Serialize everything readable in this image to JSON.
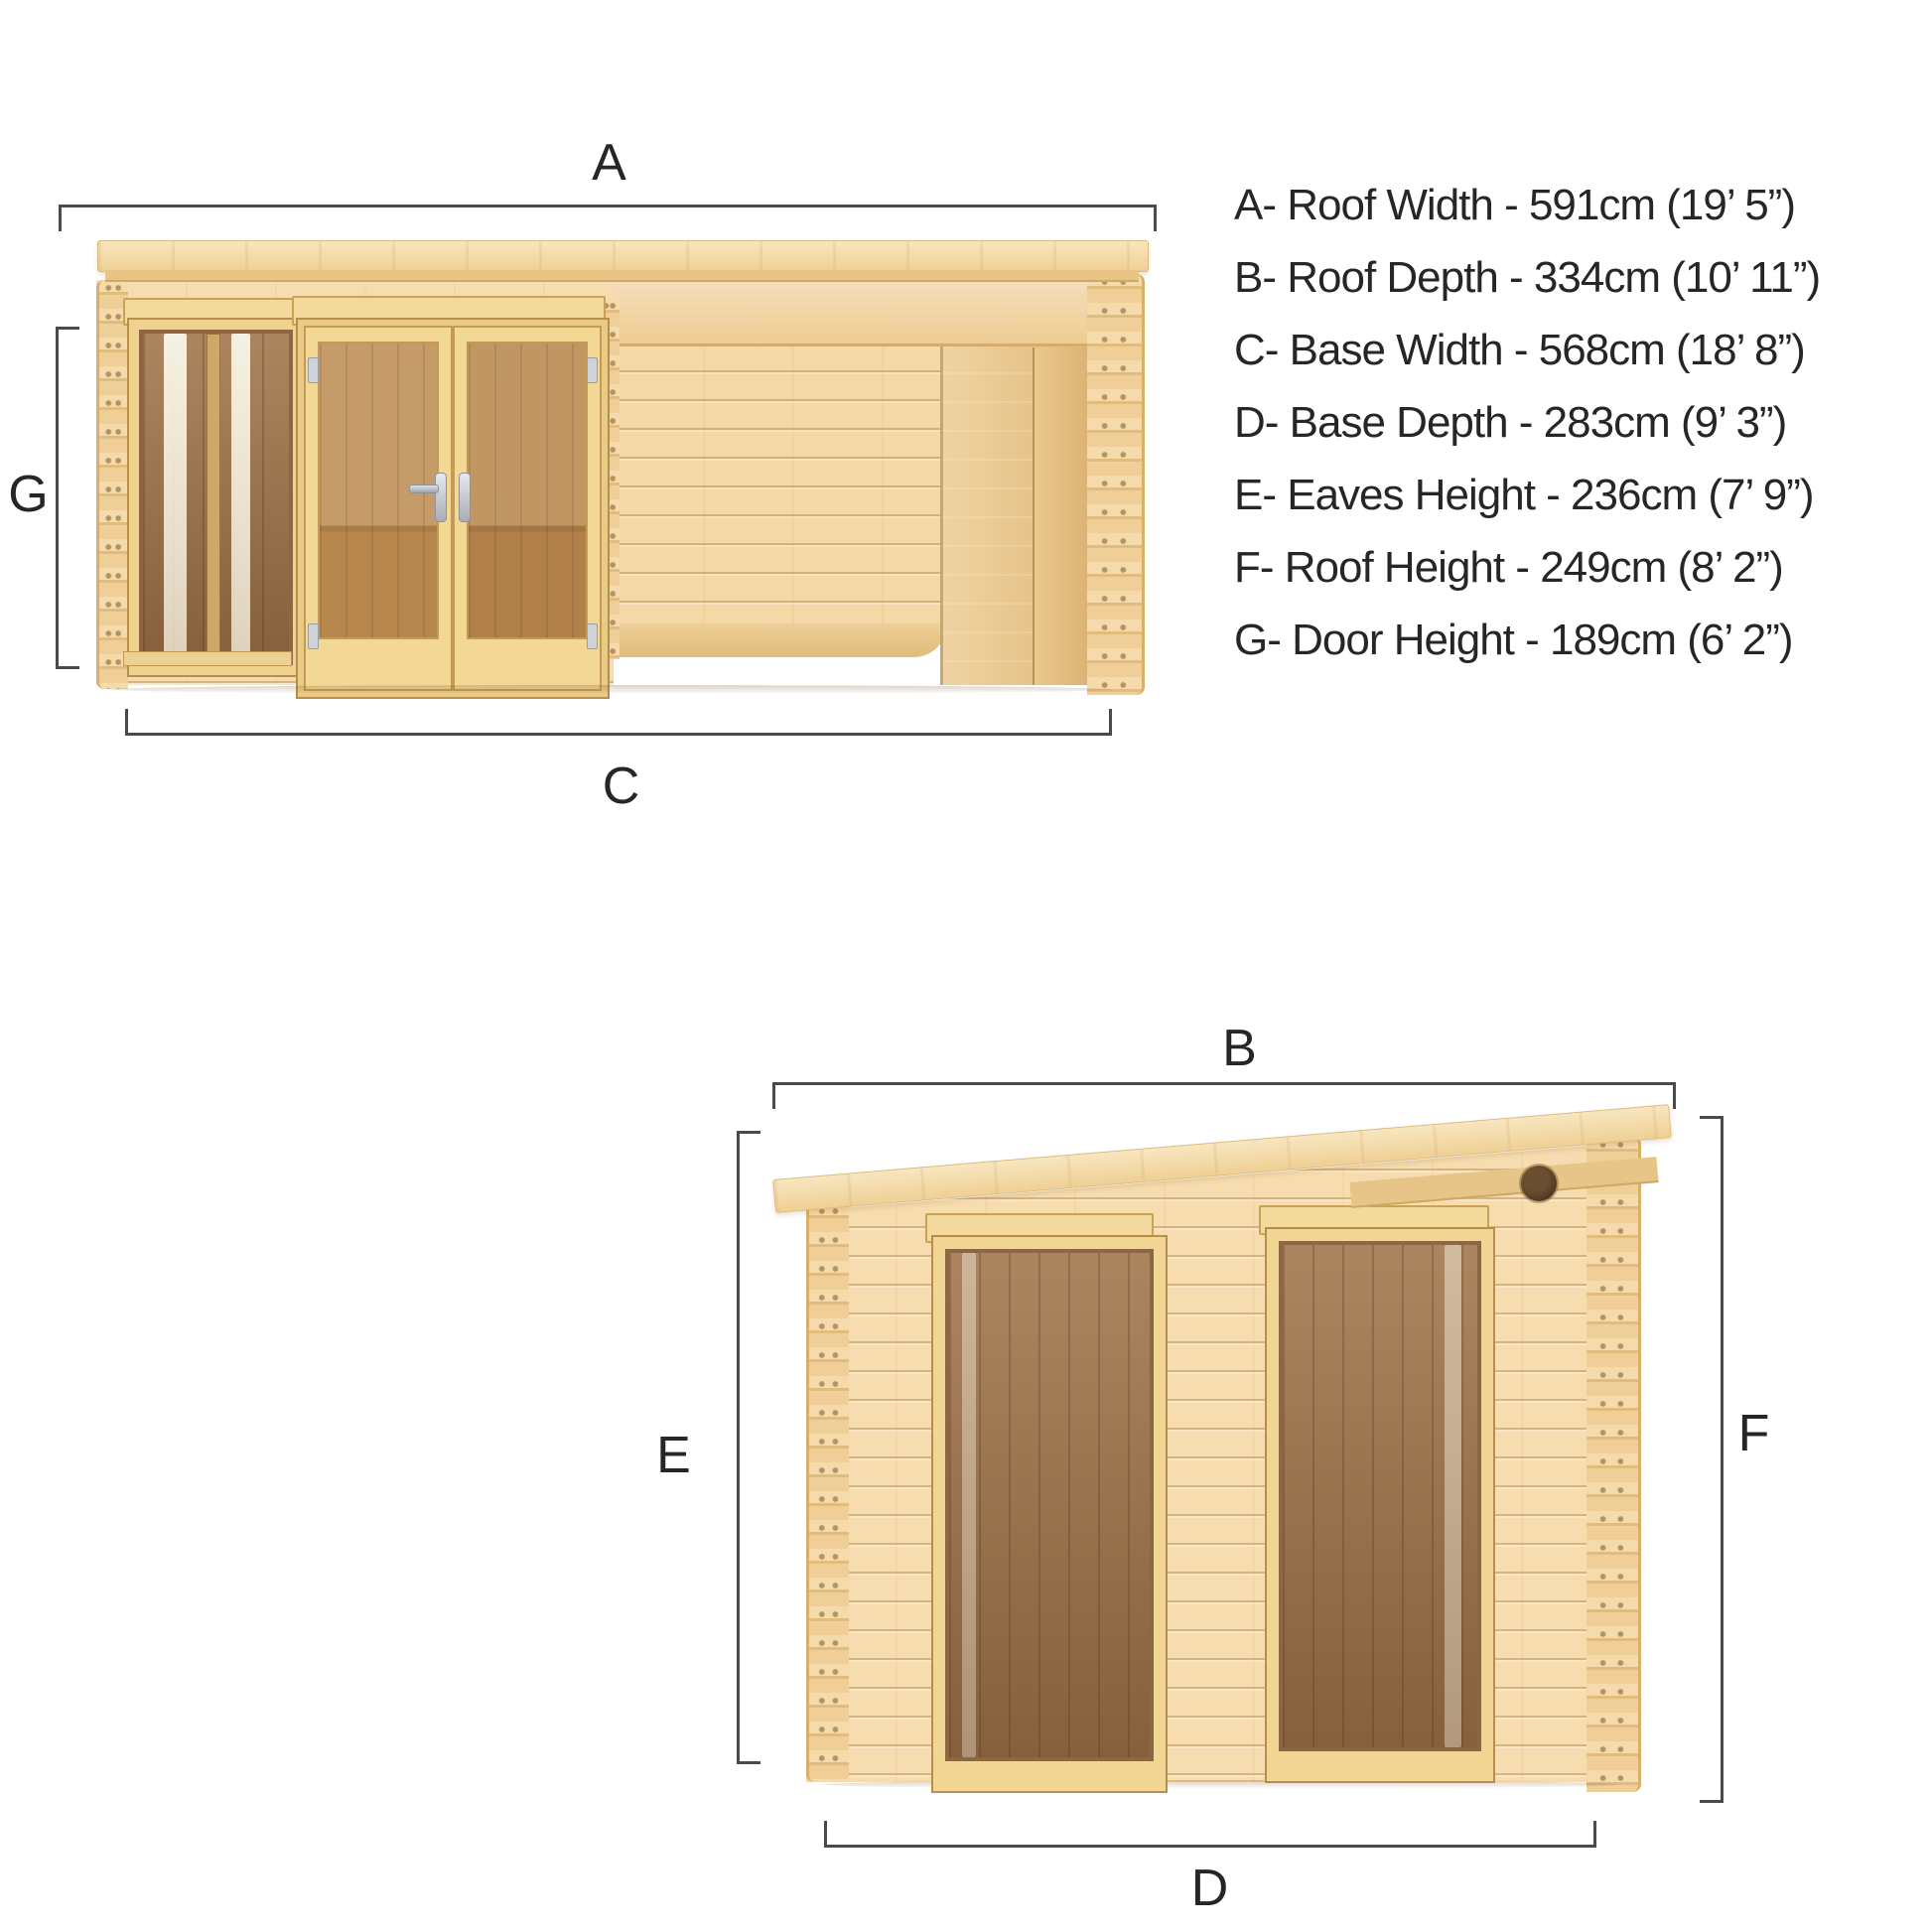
{
  "page": {
    "type": "product-dimension-diagram",
    "subject": "pent-roof log cabin with open pergola section, front and side elevations"
  },
  "colors": {
    "background": "#ffffff",
    "wood_light": "#f6dcae",
    "wood_mid": "#efd094",
    "wood_line": "#c9a258",
    "interior_dark": "#9b7149",
    "glass_reflection": "#f7f2e2",
    "metal_fitting": "#cfd3d9",
    "dimension_line": "#4a4a4a",
    "text": "#262626"
  },
  "top_view": {
    "name": "front-elevation",
    "labels": {
      "roof_width": "A",
      "base_width": "C",
      "door_height": "G"
    }
  },
  "bottom_view": {
    "name": "side-elevation",
    "labels": {
      "roof_depth": "B",
      "base_depth": "D",
      "eaves_height": "E",
      "roof_height": "F"
    }
  },
  "spec_list": {
    "lines": [
      "A- Roof Width - 591cm (19’ 5”)",
      "B- Roof Depth - 334cm (10’ 11”)",
      "C- Base Width - 568cm (18’ 8”)",
      "D- Base Depth - 283cm (9’ 3”)",
      "E- Eaves Height - 236cm (7’ 9”)",
      "F- Roof Height - 249cm (8’ 2”)",
      "G- Door Height - 189cm (6’ 2”)"
    ],
    "items": [
      {
        "code": "A",
        "dimension": "Roof Width",
        "metric": "591cm",
        "imperial": "19’ 5”"
      },
      {
        "code": "B",
        "dimension": "Roof Depth",
        "metric": "334cm",
        "imperial": "10’ 11”"
      },
      {
        "code": "C",
        "dimension": "Base Width",
        "metric": "568cm",
        "imperial": "18’ 8”"
      },
      {
        "code": "D",
        "dimension": "Base Depth",
        "metric": "283cm",
        "imperial": "9’ 3”"
      },
      {
        "code": "E",
        "dimension": "Eaves Height",
        "metric": "236cm",
        "imperial": "7’ 9”"
      },
      {
        "code": "F",
        "dimension": "Roof Height",
        "metric": "249cm",
        "imperial": "8’ 2”"
      },
      {
        "code": "G",
        "dimension": "Door Height",
        "metric": "189cm",
        "imperial": "6’ 2”"
      }
    ]
  }
}
